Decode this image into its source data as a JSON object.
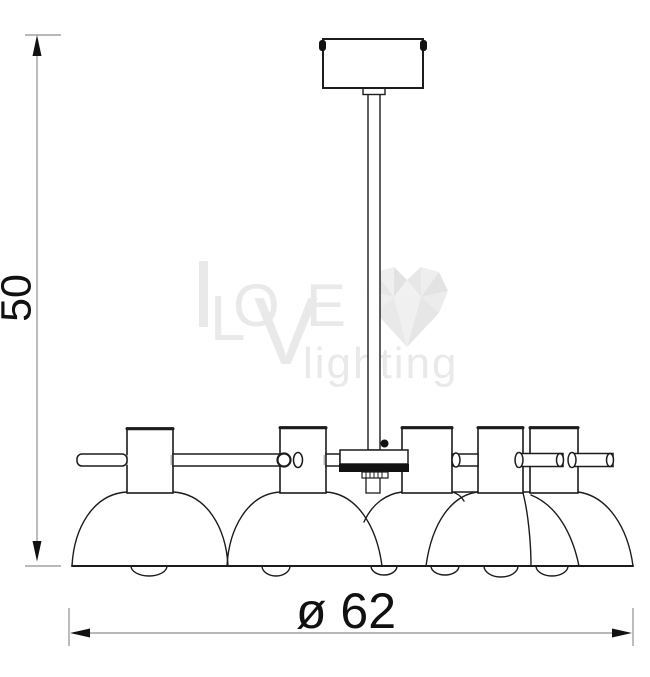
{
  "title": "Chandelier technical dimension drawing",
  "drawing": {
    "subject": "six-light dome-shade chandelier, side elevation",
    "line_color": "#1c1c1c",
    "dim_line_color": "#8f8f8f",
    "background": "#ffffff"
  },
  "labels": {
    "height": "50",
    "diameter": "ø 62"
  },
  "watermark": {
    "love_l": "L",
    "love_o": "O",
    "love_v": "V",
    "love_e": "E",
    "tagline": "lighting",
    "color": "#e9e9e9"
  }
}
